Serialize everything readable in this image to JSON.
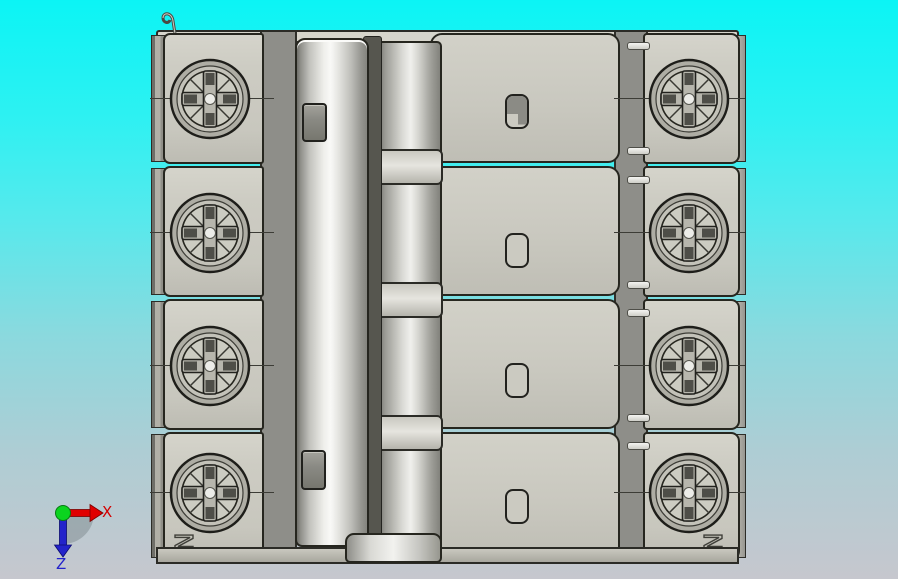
{
  "viewport": {
    "type": "3d-cad-view",
    "object": "Four-pole circuit breaker, front elevation",
    "background": {
      "top": "#0bf4f5",
      "bottom": "#c6c7ce"
    }
  },
  "model": {
    "pole_count": 4,
    "neutral_labels": {
      "left": "N",
      "right": "N"
    },
    "colors": {
      "housing_light": "#cdccc3",
      "housing_mid": "#aeada4",
      "housing_dark": "#8e8e89",
      "edge_outline": "#26261f",
      "metal_highlight": "#f9f9f7"
    }
  },
  "axis_triad": {
    "x_label": "X",
    "z_label": "Z",
    "x_color": "#d40000",
    "z_color": "#2323cb",
    "origin_color": "#0bd41f"
  }
}
